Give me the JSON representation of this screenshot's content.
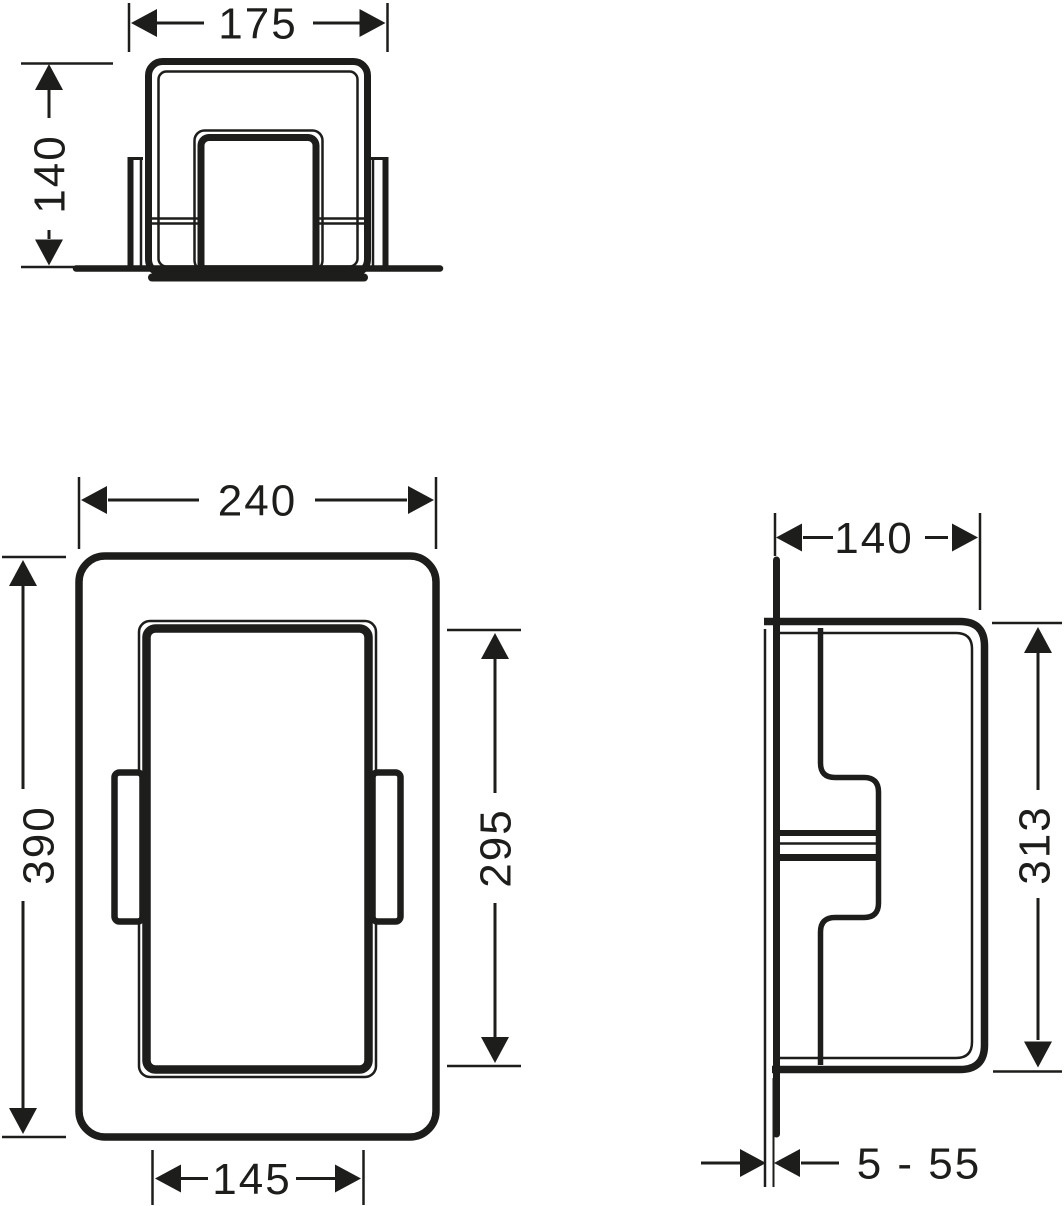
{
  "colors": {
    "ink": "#1d1d1b",
    "paper": "#ffffff"
  },
  "dimensions": {
    "top_width": "175",
    "top_depth": "140",
    "front_outer_width": "240",
    "front_outer_height": "390",
    "front_opening_height": "295",
    "front_opening_width": "145",
    "side_depth": "140",
    "side_body_height": "313",
    "side_mounting_range": "5 - 55"
  }
}
